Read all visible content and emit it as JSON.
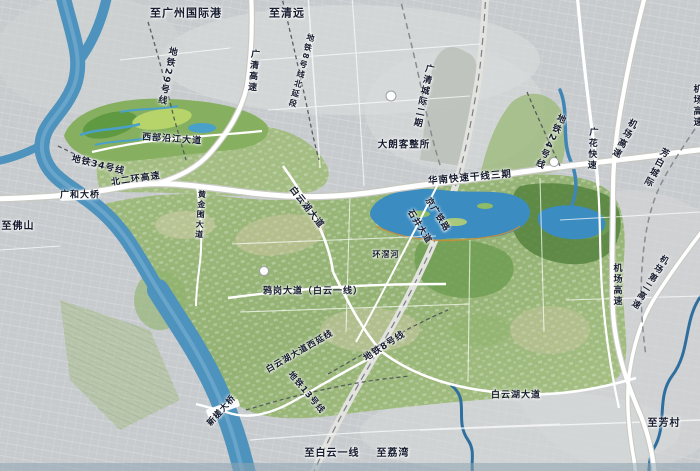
{
  "map": {
    "theme": {
      "bg": "#c7cbce",
      "water": "#4e93bd",
      "lake": "#3a8cc1",
      "green": "#9cb87a",
      "road": "#ffffff",
      "label": "#161c2e"
    },
    "labels": [
      {
        "text": "至广州国际港",
        "x": 186,
        "y": 13,
        "rot": 0,
        "fs": 11,
        "v": false
      },
      {
        "text": "至清远",
        "x": 287,
        "y": 13,
        "rot": 0,
        "fs": 11,
        "v": false
      },
      {
        "text": "地铁29号线",
        "x": 166,
        "y": 76,
        "rot": 12,
        "fs": 9,
        "v": true
      },
      {
        "text": "广清高速",
        "x": 252,
        "y": 71,
        "rot": 5,
        "fs": 9,
        "v": true
      },
      {
        "text": "地铁8号线北延段",
        "x": 301,
        "y": 71,
        "rot": 15,
        "fs": 8,
        "v": true
      },
      {
        "text": "广清城际二期",
        "x": 422,
        "y": 96,
        "rot": 12,
        "fs": 9,
        "v": true
      },
      {
        "text": "地铁24号线",
        "x": 549,
        "y": 141,
        "rot": 25,
        "fs": 9,
        "v": true
      },
      {
        "text": "广花快速",
        "x": 591,
        "y": 149,
        "rot": 3,
        "fs": 9,
        "v": true
      },
      {
        "text": "机场高速",
        "x": 623,
        "y": 138,
        "rot": 28,
        "fs": 9,
        "v": true
      },
      {
        "text": "芳白城际",
        "x": 655,
        "y": 167,
        "rot": 28,
        "fs": 9,
        "v": true
      },
      {
        "text": "机场高速",
        "x": 696,
        "y": 106,
        "rot": 0,
        "fs": 9,
        "v": true
      },
      {
        "text": "大朗客整所",
        "x": 404,
        "y": 145,
        "rot": 0,
        "fs": 9.5,
        "v": false
      },
      {
        "text": "华南快速干线三期",
        "x": 470,
        "y": 178,
        "rot": -5,
        "fs": 9.5,
        "v": false
      },
      {
        "text": "西部沿江大道",
        "x": 172,
        "y": 140,
        "rot": 4,
        "fs": 9,
        "v": false
      },
      {
        "text": "地铁34号线",
        "x": 98,
        "y": 166,
        "rot": 14,
        "fs": 9,
        "v": false
      },
      {
        "text": "北二环高速",
        "x": 136,
        "y": 180,
        "rot": -8,
        "fs": 9,
        "v": false
      },
      {
        "text": "广和大桥",
        "x": 80,
        "y": 196,
        "rot": 0,
        "fs": 9,
        "v": false
      },
      {
        "text": "黄金围大道",
        "x": 200,
        "y": 215,
        "rot": 4,
        "fs": 8,
        "v": true
      },
      {
        "text": "白云湖大道",
        "x": 306,
        "y": 208,
        "rot": 52,
        "fs": 9,
        "v": false
      },
      {
        "text": "石井大道",
        "x": 419,
        "y": 227,
        "rot": 58,
        "fs": 8.5,
        "v": false
      },
      {
        "text": "京广铁路",
        "x": 437,
        "y": 215,
        "rot": 58,
        "fs": 8.5,
        "v": false
      },
      {
        "text": "环滘河",
        "x": 386,
        "y": 255,
        "rot": 0,
        "fs": 8,
        "v": false
      },
      {
        "text": "鸦岗大道（白云一线）",
        "x": 313,
        "y": 292,
        "rot": 0,
        "fs": 9,
        "v": false
      },
      {
        "text": "白云湖大道西延线",
        "x": 300,
        "y": 352,
        "rot": -30,
        "fs": 8.5,
        "v": false
      },
      {
        "text": "地铁8号线",
        "x": 385,
        "y": 347,
        "rot": -33,
        "fs": 9,
        "v": false
      },
      {
        "text": "地铁13号线",
        "x": 306,
        "y": 393,
        "rot": 50,
        "fs": 8.5,
        "v": false
      },
      {
        "text": "新槎大桥",
        "x": 222,
        "y": 411,
        "rot": -48,
        "fs": 8.5,
        "v": false
      },
      {
        "text": "机场高速",
        "x": 616,
        "y": 285,
        "rot": 0,
        "fs": 9,
        "v": true
      },
      {
        "text": "机场第二高速",
        "x": 649,
        "y": 282,
        "rot": 32,
        "fs": 8.5,
        "v": true
      },
      {
        "text": "白云湖大道",
        "x": 516,
        "y": 396,
        "rot": 0,
        "fs": 9,
        "v": false
      },
      {
        "text": "至白云一线",
        "x": 332,
        "y": 454,
        "rot": 0,
        "fs": 10,
        "v": false
      },
      {
        "text": "至荔湾",
        "x": 393,
        "y": 454,
        "rot": 0,
        "fs": 10,
        "v": false
      },
      {
        "text": "至佛山",
        "x": 18,
        "y": 227,
        "rot": 0,
        "fs": 10,
        "v": false
      },
      {
        "text": "至芳村",
        "x": 664,
        "y": 424,
        "rot": 0,
        "fs": 10,
        "v": false
      }
    ]
  }
}
